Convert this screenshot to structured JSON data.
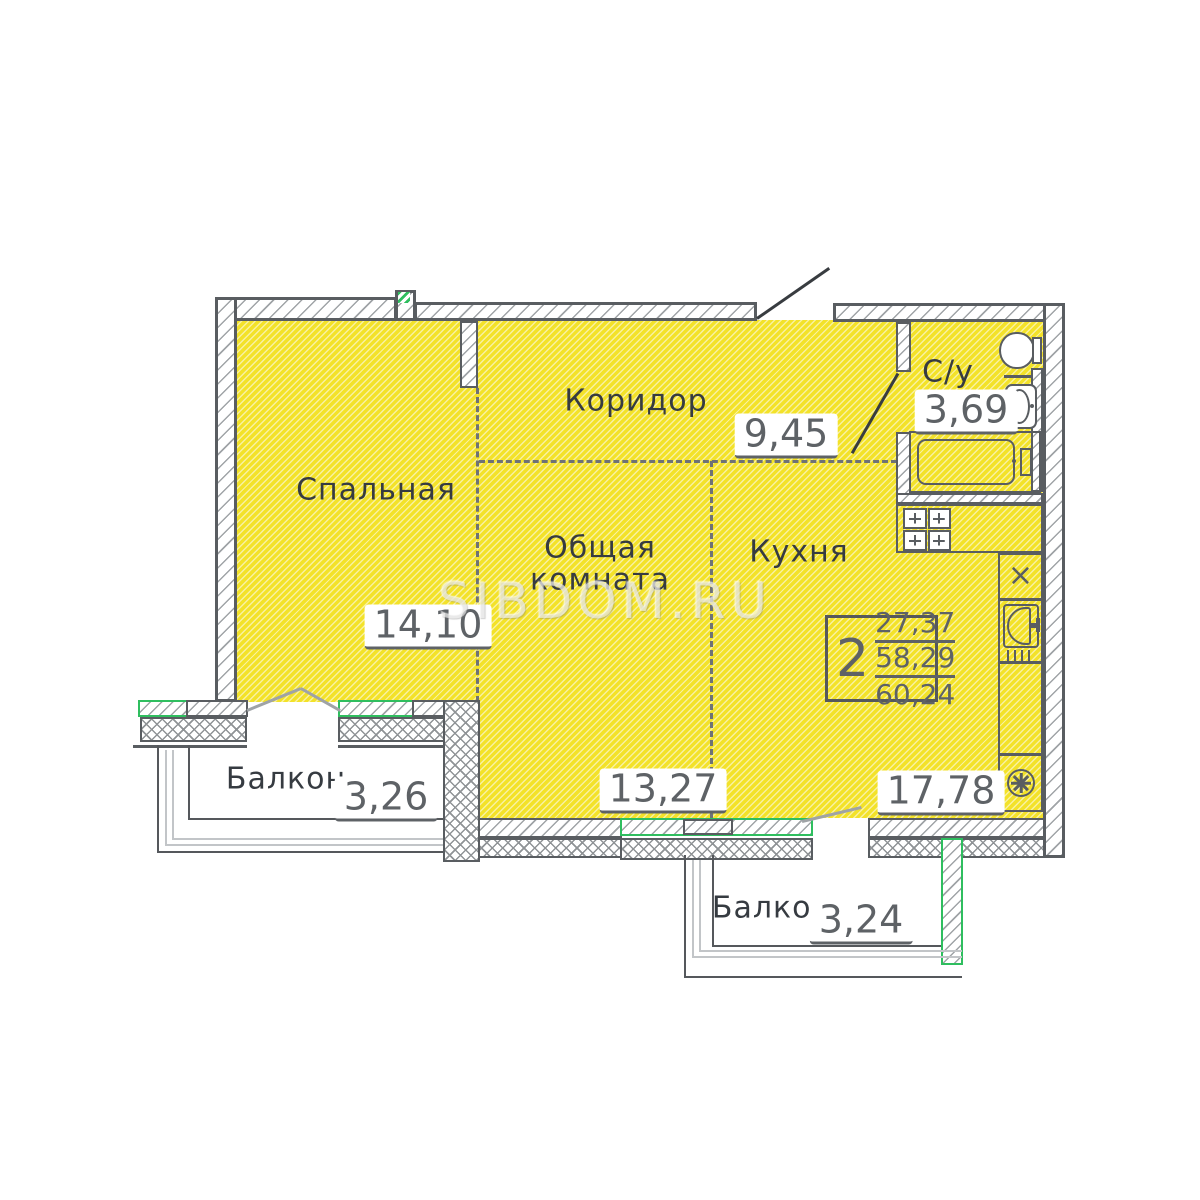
{
  "watermark": "SIBDOM.RU",
  "rooms": {
    "bedroom": {
      "label": "Спальная",
      "area": "14,10"
    },
    "corridor": {
      "label": "Коридор",
      "area": "9,45"
    },
    "living": {
      "label_line1": "Общая",
      "label_line2": "комната",
      "area": "13,27"
    },
    "kitchen": {
      "label": "Кухня",
      "area": "17,78"
    },
    "bathroom": {
      "label": "С/у",
      "area": "3,69"
    },
    "balcony_left": {
      "label": "Балкон",
      "area": "3,26"
    },
    "balcony_bottom": {
      "label": "Балкон",
      "area": "3,24"
    }
  },
  "info_box": {
    "rooms_count": "2",
    "area_values": [
      "27,37",
      "58,29",
      "60,24"
    ]
  },
  "colors": {
    "room_fill": "#f3e229",
    "accent_green": "#2fbe5f",
    "wall_line": "#595d61"
  }
}
